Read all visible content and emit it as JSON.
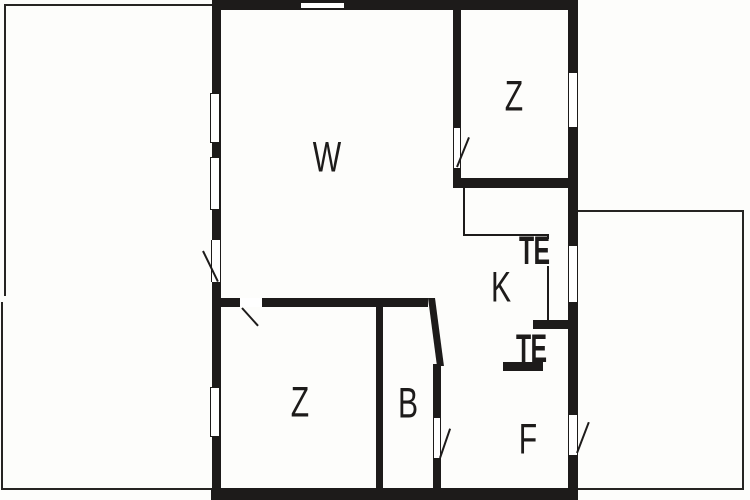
{
  "plan_title": "holiday-house-floor-plan",
  "colors": {
    "wall": "#1d1b1a",
    "background": "#fdfdfb",
    "line": "#262422"
  },
  "rooms": {
    "living": {
      "label": "W"
    },
    "bedroom_top": {
      "label": "Z"
    },
    "bedroom_bottom": {
      "label": "Z"
    },
    "kitchen": {
      "label": "K"
    },
    "bath": {
      "label": "B"
    },
    "hall": {
      "label": "F"
    },
    "te_top": {
      "label": "TE"
    },
    "te_bottom": {
      "label": "TE"
    }
  }
}
